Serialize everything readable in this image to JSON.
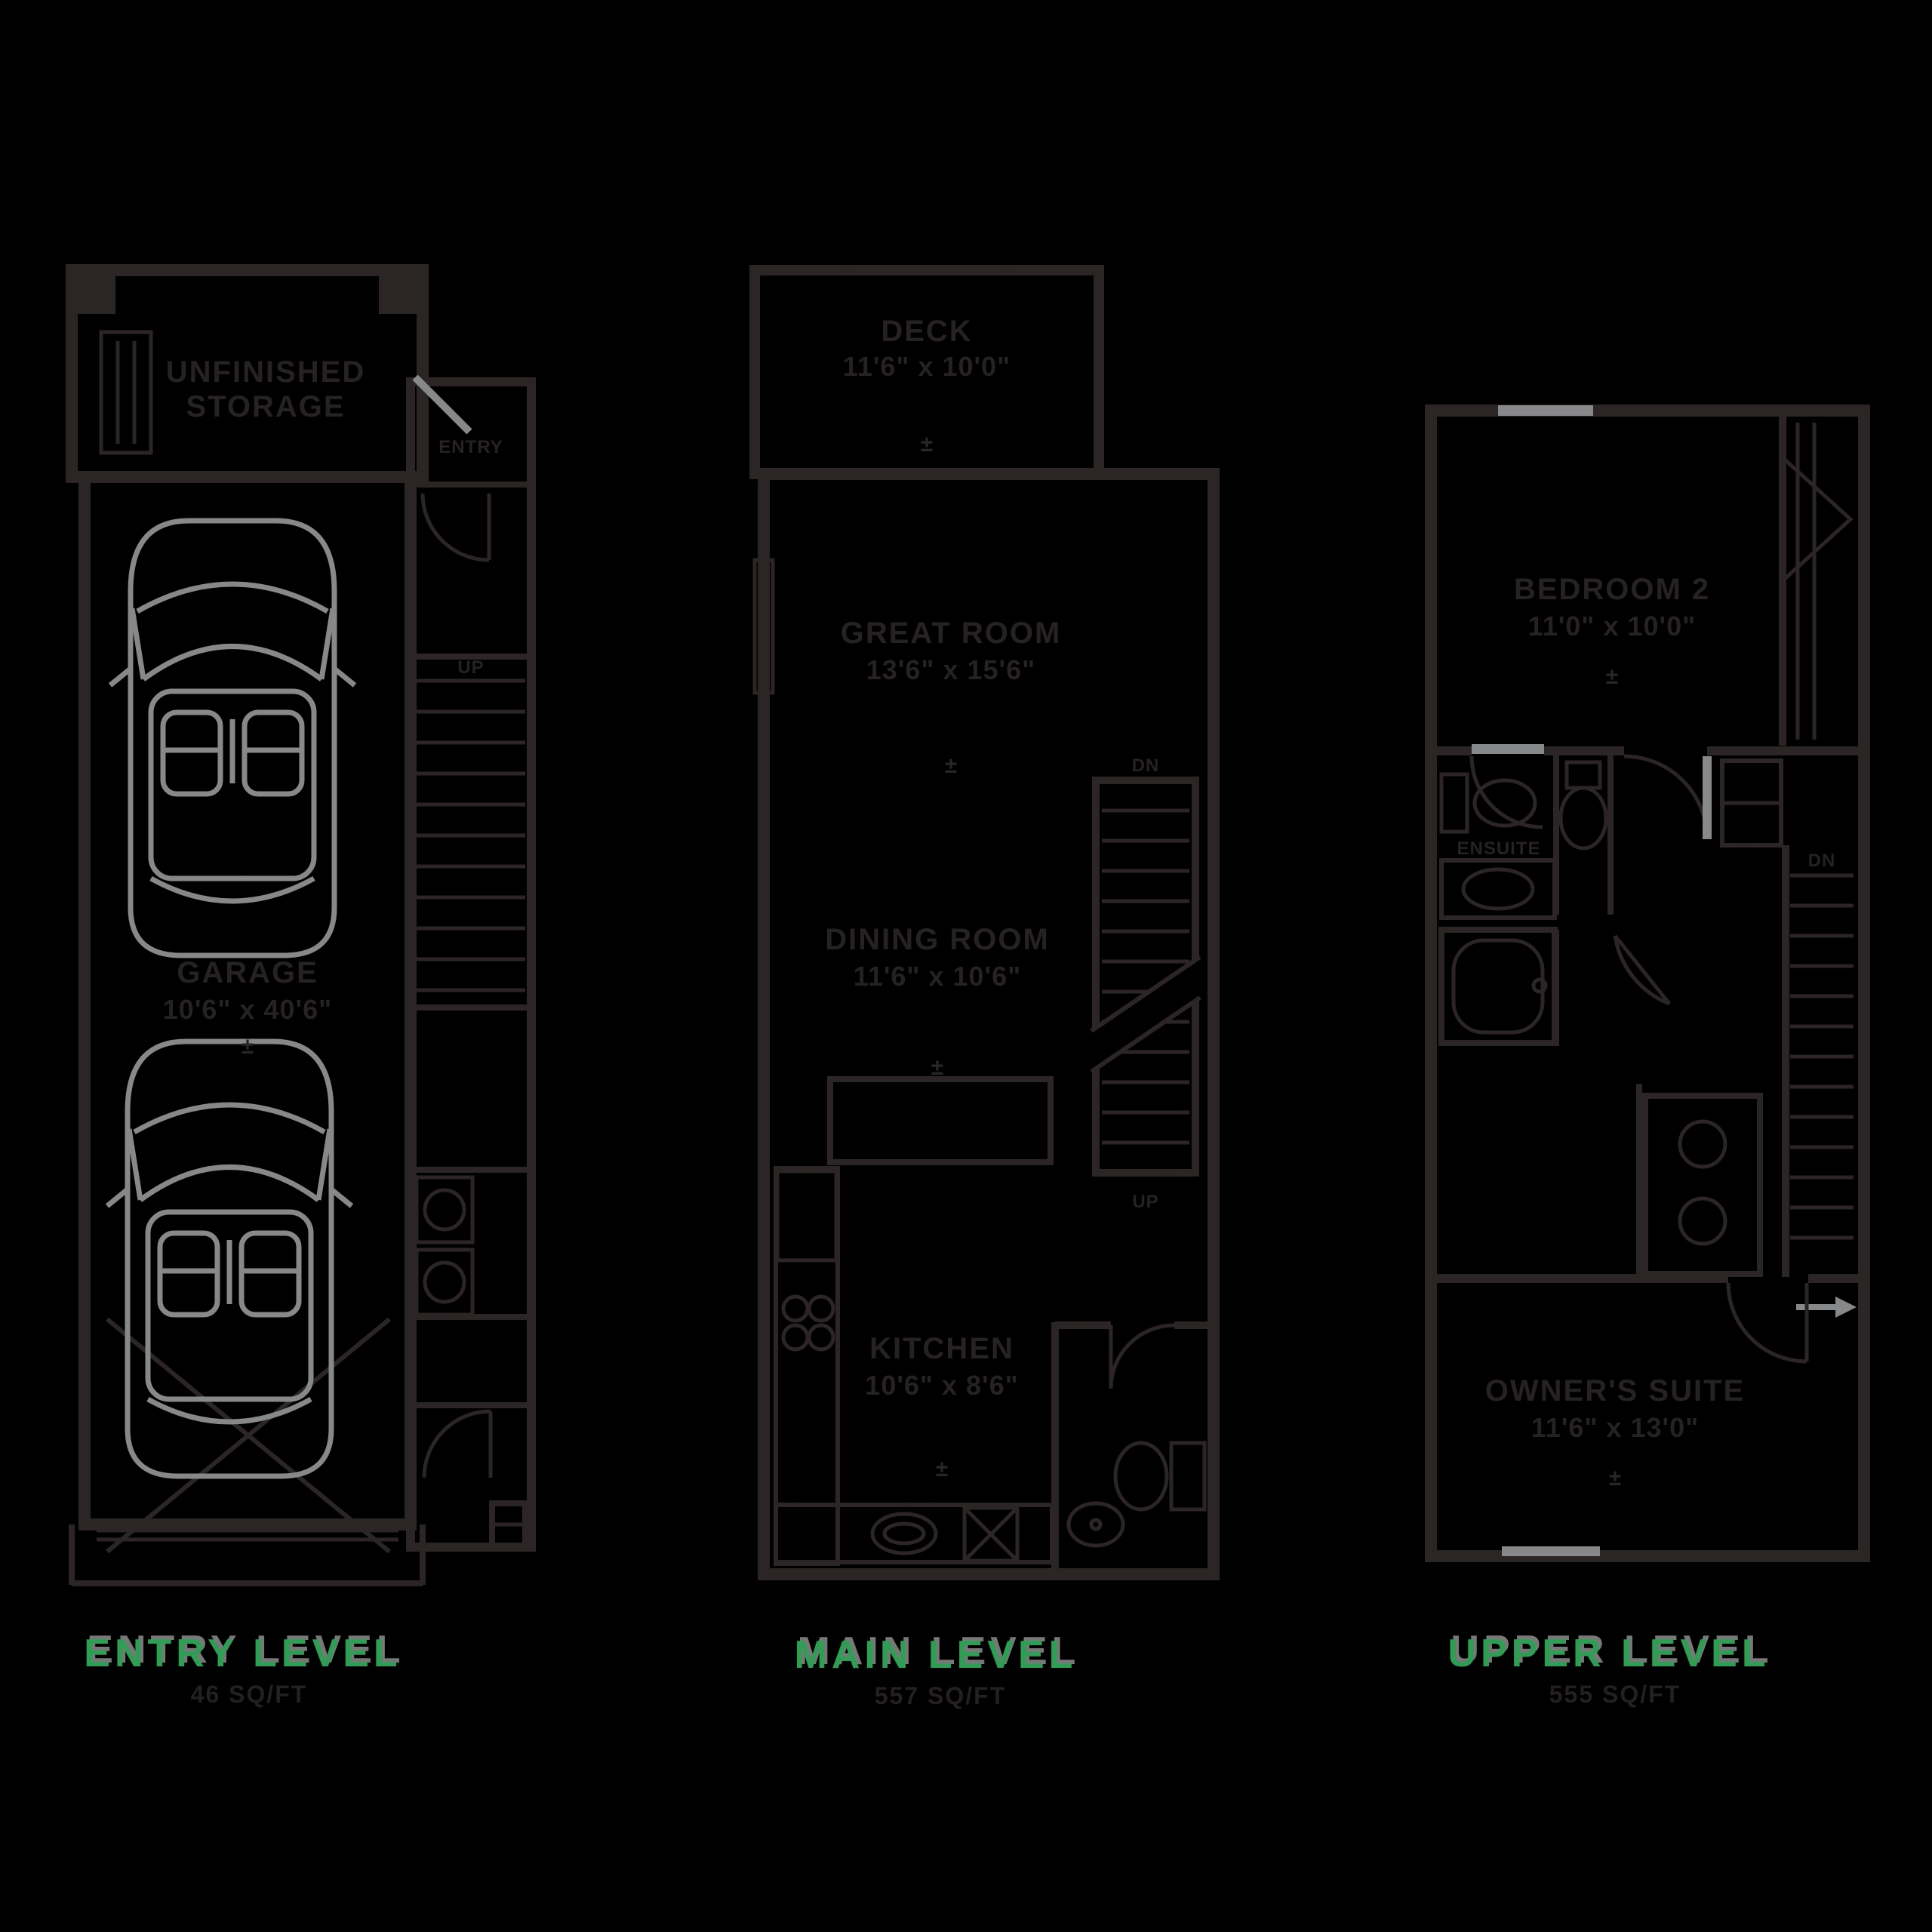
{
  "palette": {
    "background": "#000000",
    "line_dark": "#231f20",
    "accent_gray": "#87888a",
    "level_green": "#2f9e55",
    "shadow_gray": "#787878"
  },
  "levels": {
    "entry": {
      "label": "ENTRY LEVEL",
      "area": "46 SQ/FT"
    },
    "main": {
      "label": "MAIN LEVEL",
      "area": "557 SQ/FT"
    },
    "upper": {
      "label": "UPPER LEVEL",
      "area": "555 SQ/FT"
    }
  },
  "rooms": {
    "storage_line1": "UNFINISHED",
    "storage_line2": "STORAGE",
    "garage": {
      "name": "GARAGE",
      "dims": "10'6\" x 40'6\"",
      "tol": "±"
    },
    "deck": {
      "name": "DECK",
      "dims": "11'6\" x 10'0\"",
      "tol": "±"
    },
    "great_room": {
      "name": "GREAT ROOM",
      "dims": "13'6\" x 15'6\"",
      "tol": "±"
    },
    "dining_room": {
      "name": "DINING ROOM",
      "dims": "11'6\" x 10'6\"",
      "tol": "±"
    },
    "kitchen": {
      "name": "KITCHEN",
      "dims": "10'6\" x 8'6\"",
      "tol": "±"
    },
    "bedroom2": {
      "name": "BEDROOM 2",
      "dims": "11'0\" x 10'0\"",
      "tol": "±"
    },
    "owners_suite": {
      "name": "OWNER'S SUITE",
      "dims": "11'6\" x 13'0\"",
      "tol": "±"
    },
    "ensuite": {
      "name": "ENSUITE"
    }
  },
  "annotations": {
    "up": "UP",
    "dn": "DN",
    "entry": "ENTRY"
  }
}
